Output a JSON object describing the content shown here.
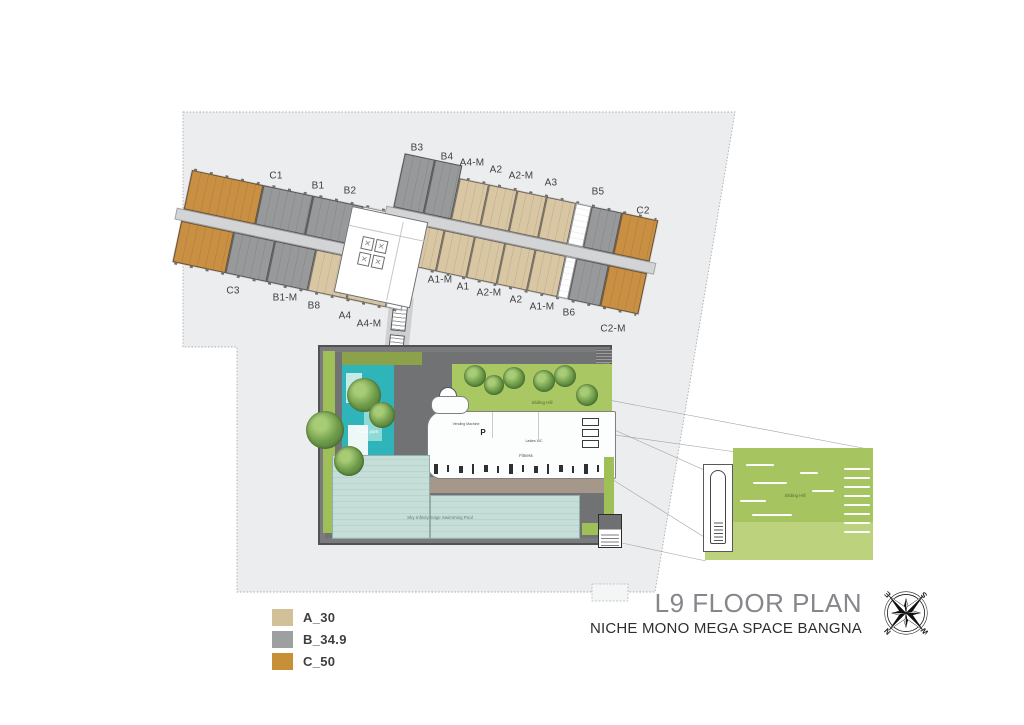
{
  "title": {
    "main": "L9 FLOOR PLAN",
    "subtitle": "NICHE MONO MEGA SPACE BANGNA"
  },
  "legend": {
    "items": [
      {
        "code": "A_30",
        "color": "#d2c099"
      },
      {
        "code": "B_34.9",
        "color": "#9d9fa1"
      },
      {
        "code": "C_50",
        "color": "#c78f36"
      }
    ]
  },
  "compass": {
    "letters": {
      "n": "N",
      "e": "E",
      "s": "S",
      "w": "W"
    },
    "rotation_deg": -135
  },
  "plan": {
    "site_color": "#ecedee",
    "unit_colors": {
      "A": "#d9c7a4",
      "B": "#98999b",
      "C": "#c98f42"
    },
    "unit_labels": [
      {
        "text": "C1",
        "x": 276,
        "y": 176
      },
      {
        "text": "B1",
        "x": 318,
        "y": 186
      },
      {
        "text": "B2",
        "x": 350,
        "y": 191
      },
      {
        "text": "B3",
        "x": 417,
        "y": 148
      },
      {
        "text": "B4",
        "x": 447,
        "y": 157
      },
      {
        "text": "A4-M",
        "x": 472,
        "y": 163
      },
      {
        "text": "A2",
        "x": 496,
        "y": 170
      },
      {
        "text": "A2-M",
        "x": 521,
        "y": 176
      },
      {
        "text": "A3",
        "x": 551,
        "y": 183
      },
      {
        "text": "B5",
        "x": 598,
        "y": 192
      },
      {
        "text": "C2",
        "x": 643,
        "y": 211
      },
      {
        "text": "C3",
        "x": 233,
        "y": 291
      },
      {
        "text": "B1-M",
        "x": 285,
        "y": 298
      },
      {
        "text": "B8",
        "x": 314,
        "y": 306
      },
      {
        "text": "A4",
        "x": 345,
        "y": 316
      },
      {
        "text": "A4-M",
        "x": 369,
        "y": 324
      },
      {
        "text": "A1-M",
        "x": 440,
        "y": 280
      },
      {
        "text": "A1",
        "x": 463,
        "y": 287
      },
      {
        "text": "A2-M",
        "x": 489,
        "y": 293
      },
      {
        "text": "A2",
        "x": 516,
        "y": 300
      },
      {
        "text": "A1-M",
        "x": 542,
        "y": 307
      },
      {
        "text": "B6",
        "x": 569,
        "y": 313
      },
      {
        "text": "C2-M",
        "x": 613,
        "y": 329
      }
    ],
    "wings": {
      "left_top": [
        {
          "label": "C1",
          "type": "C",
          "w": 1.45
        },
        {
          "label": "B1",
          "type": "B",
          "w": 1
        },
        {
          "label": "B2",
          "type": "B",
          "w": 1
        },
        {
          "label": "",
          "type": "core",
          "w": 1.15
        }
      ],
      "left_bottom": [
        {
          "label": "C3",
          "type": "C",
          "w": 1.3
        },
        {
          "label": "B1-M",
          "type": "B",
          "w": 1
        },
        {
          "label": "B8",
          "type": "B",
          "w": 1
        },
        {
          "label": "A4",
          "type": "A",
          "w": 0.95
        },
        {
          "label": "A4-M",
          "type": "A",
          "w": 0.95
        },
        {
          "label": "",
          "type": "core",
          "w": 0.35
        }
      ],
      "right_top": [
        {
          "label": "B3",
          "type": "B",
          "w": 1,
          "tall": true
        },
        {
          "label": "B4",
          "type": "B",
          "w": 0.9,
          "tall": true
        },
        {
          "label": "A4-M",
          "type": "A",
          "w": 0.95
        },
        {
          "label": "A2",
          "type": "A",
          "w": 0.95
        },
        {
          "label": "A2-M",
          "type": "A",
          "w": 0.95
        },
        {
          "label": "A3",
          "type": "A",
          "w": 0.95
        },
        {
          "label": "",
          "type": "core",
          "w": 0.5
        },
        {
          "label": "B5",
          "type": "B",
          "w": 1
        },
        {
          "label": "C2",
          "type": "C",
          "w": 1.2
        }
      ],
      "right_bottom": [
        {
          "label": "",
          "type": "core",
          "w": 0.7
        },
        {
          "label": "A1-M",
          "type": "A",
          "w": 0.95
        },
        {
          "label": "A1",
          "type": "A",
          "w": 0.95
        },
        {
          "label": "A2-M",
          "type": "A",
          "w": 0.95
        },
        {
          "label": "A2",
          "type": "A",
          "w": 0.95
        },
        {
          "label": "A1-M",
          "type": "A",
          "w": 0.95
        },
        {
          "label": "",
          "type": "core",
          "w": 0.3
        },
        {
          "label": "B6",
          "type": "B",
          "w": 1
        },
        {
          "label": "C2-M",
          "type": "C",
          "w": 1.2
        }
      ]
    },
    "amenities": {
      "aqua_park": "Aqua park",
      "sliding_hill": "Sliding Hill",
      "vending": "Vending Machine",
      "parking": "P",
      "ladies_wc": "Ladies WC",
      "fitness": "Fitness",
      "pool": "Sky Infinity Edge Swimming Pool",
      "detail_sliding_hill": "Sliding Hill"
    }
  }
}
